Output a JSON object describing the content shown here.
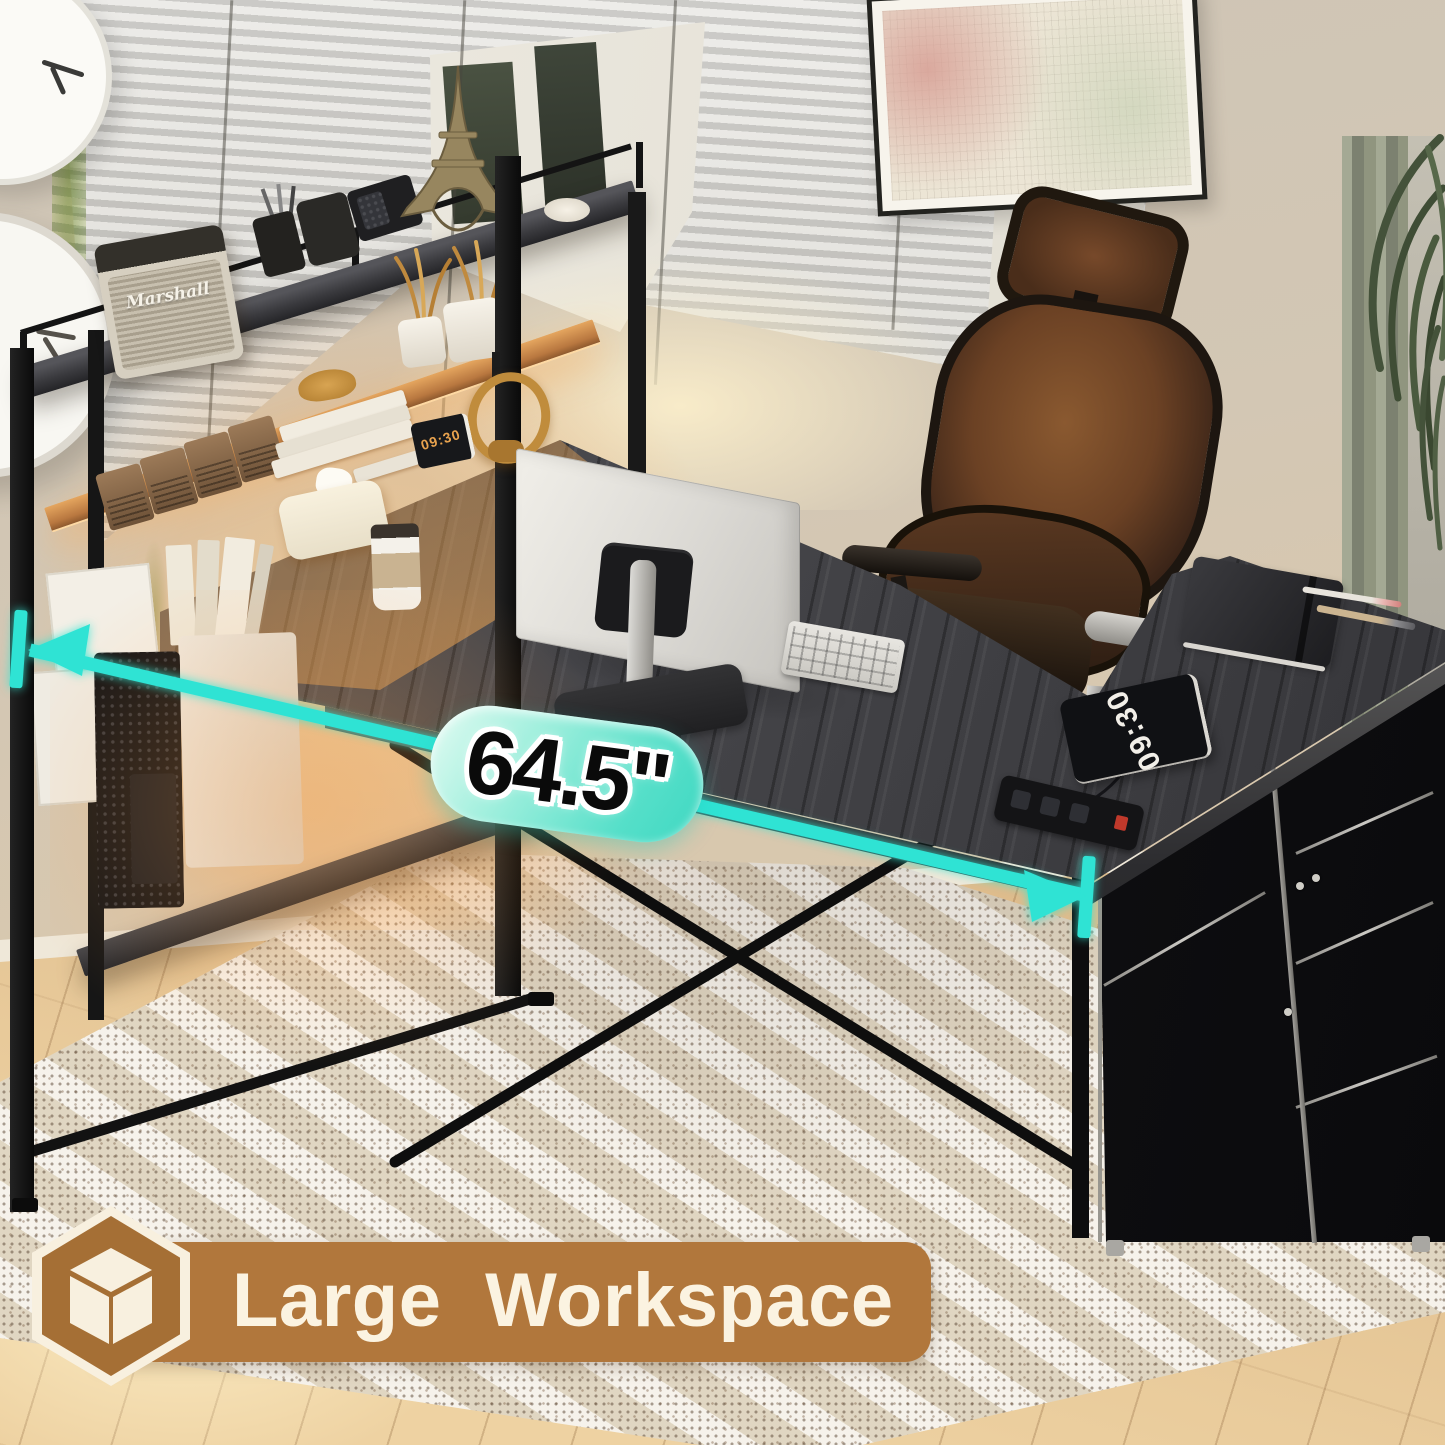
{
  "annotations": {
    "measurement": {
      "value": "64.5\"",
      "color": "#2fe3d4"
    },
    "banner": {
      "label": "Large Workspace",
      "icon": "cube-icon",
      "background": "#b1773c",
      "text_color": "#fbf3e1"
    }
  },
  "props": {
    "desk_clock": {
      "time": "09:30"
    },
    "shelf_clock": {
      "time": "09:30"
    },
    "speaker": {
      "brand": "Marshall"
    }
  },
  "palette": {
    "accent_teal": "#2fe3d4",
    "banner_brown": "#b1773c",
    "badge_brown": "#a56f35",
    "badge_cream": "#f8f0df",
    "desk_wood": "#46464a",
    "warm_glow": "#ffb964"
  }
}
